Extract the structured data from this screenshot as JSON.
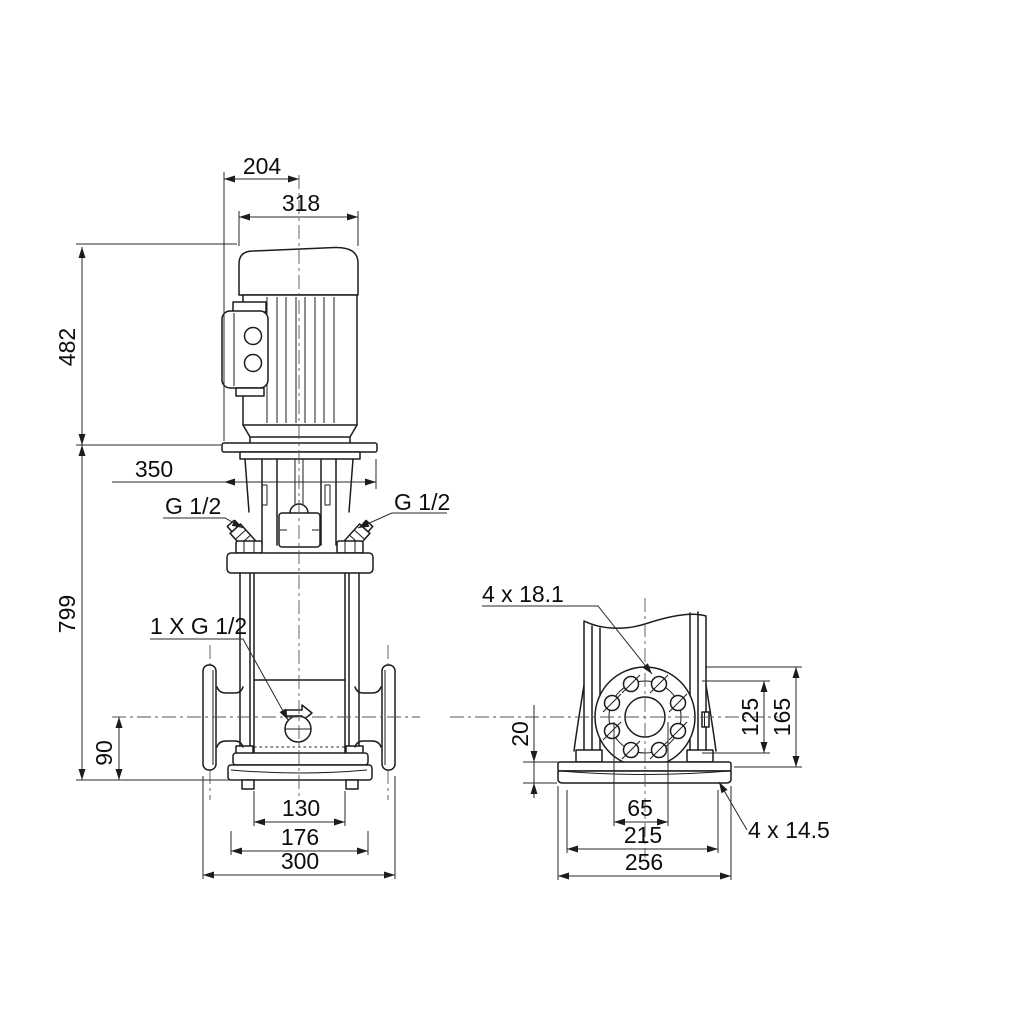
{
  "drawing": {
    "front_view": {
      "dims": {
        "width_to_center": "204",
        "motor_width": "318",
        "motor_height": "482",
        "stool_width": "350",
        "total_height": "799",
        "port_center_height": "90",
        "chamber_width": "130",
        "base_plate_width": "176",
        "port_to_port": "300"
      },
      "labels": {
        "plug_left": "G 1/2",
        "plug_right": "G 1/2",
        "drain_plug": "1 X G 1/2"
      }
    },
    "side_view": {
      "dims": {
        "foot_plate_height": "20",
        "bolt_circle": "125",
        "flange_diameter": "165",
        "port_bore": "65",
        "base_hole_spacing": "215",
        "base_width": "256"
      },
      "labels": {
        "flange_holes": "4 x 18.1",
        "base_holes": "4 x 14.5"
      }
    },
    "line_color": "#1c1c1c",
    "background": "#ffffff"
  }
}
